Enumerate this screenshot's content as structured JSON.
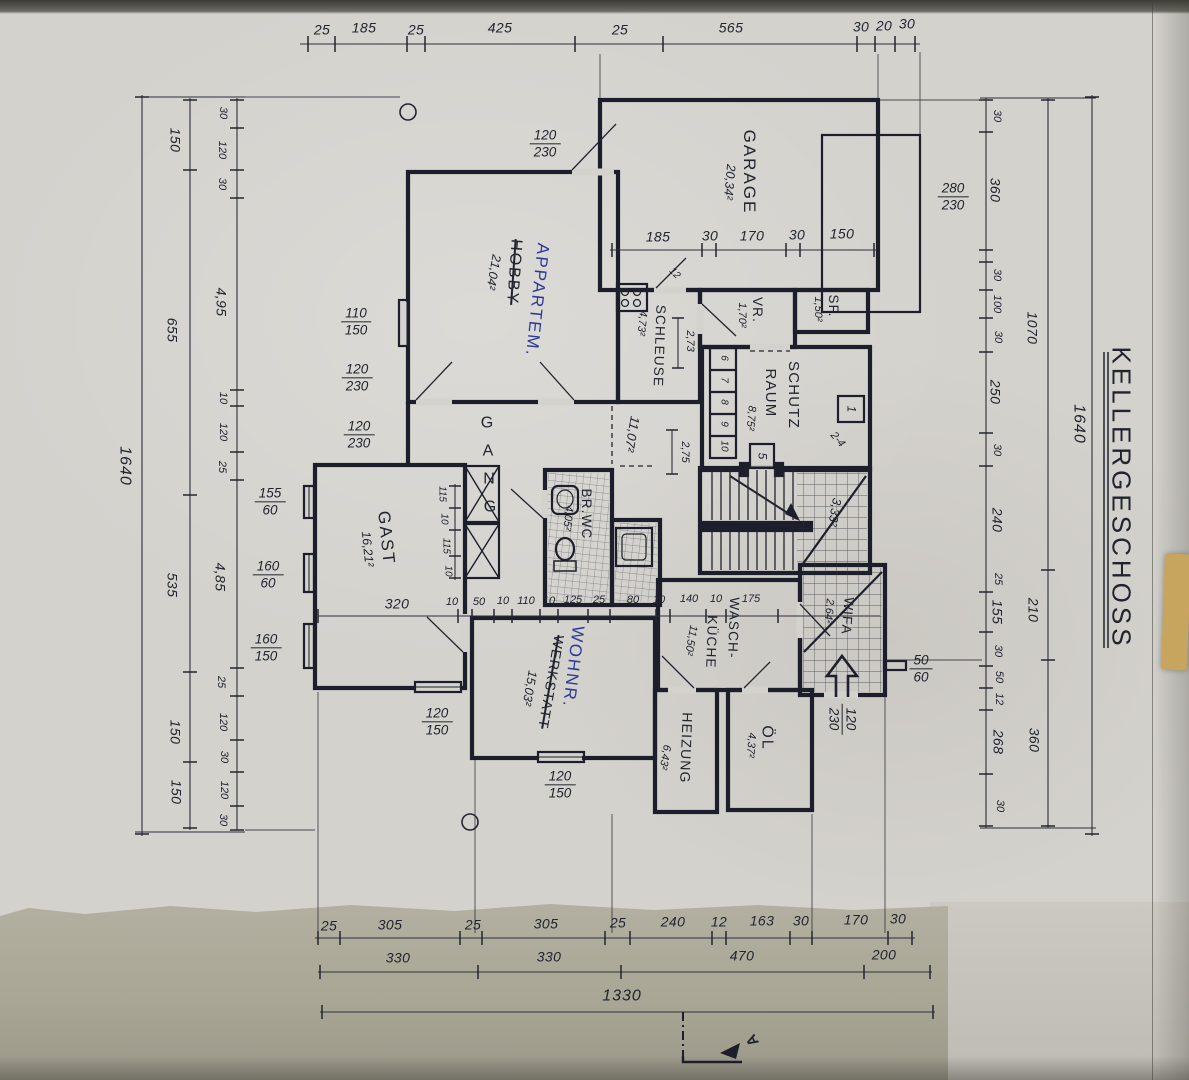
{
  "meta": {
    "plan_title": "KELLERGESCHOSS",
    "section_marker": "A",
    "total_width": "1330",
    "total_height": "1640",
    "ink_color": "#1c1f2b",
    "blue_pen_color": "#2c3a96",
    "paper_color": "#d4d2cd"
  },
  "rooms": {
    "garage": {
      "name": "GARAGE",
      "area": "20,34²"
    },
    "hobby": {
      "name": "HOBBY",
      "renamed": "APPARTEM.",
      "area": "21,04²"
    },
    "schleuse": {
      "name": "SCHLEUSE",
      "area": "4,73²"
    },
    "vr": {
      "name": "VR.",
      "area": "1,70²"
    },
    "sf": {
      "name": "SF.",
      "area": "1,50²"
    },
    "schutzraum": {
      "name_line1": "SCHUTZ",
      "name_line2": "RAUM",
      "area": "8,75²",
      "bed_numbers": [
        "6",
        "7",
        "8",
        "9",
        "10"
      ],
      "bed_right_top": "1",
      "bed_right_mid": "2-4",
      "bed_door": "5"
    },
    "gang": {
      "letters": [
        "G",
        "A",
        "N",
        "G"
      ],
      "area": "11,07²"
    },
    "gast": {
      "name": "GAST",
      "area": "16,21²"
    },
    "brwc": {
      "name": "BR.WC",
      "area": "4,05²"
    },
    "werkstatt": {
      "name": "WERKSTATT",
      "renamed": "WOHNR.",
      "area": "15,03²"
    },
    "waschkueche": {
      "name_line1": "WASCH-",
      "name_line2": "KÜCHE",
      "area": "11,50²"
    },
    "wifa": {
      "name": "WIFA",
      "area": "2,64²"
    },
    "heizung": {
      "name": "HEIZUNG",
      "area": "6,43²"
    },
    "oel": {
      "name": "ÖL",
      "area": "4,37²"
    },
    "stair_landing": {
      "area": "3,33²"
    }
  },
  "dims": {
    "top": [
      "25",
      "185",
      "25",
      "425",
      "25",
      "565",
      "30",
      "20",
      "30"
    ],
    "garage_line": [
      "185",
      "30",
      "170",
      "30",
      "150"
    ],
    "mid_line": [
      "320",
      "10",
      "50",
      "10",
      "110",
      "10",
      "125",
      "25",
      "80",
      "10",
      "140",
      "10",
      "175"
    ],
    "bottom_r1": [
      "25",
      "305",
      "25",
      "305",
      "25",
      "240",
      "12",
      "163",
      "30",
      "170",
      "30"
    ],
    "bottom_r2": [
      "330",
      "330",
      "470",
      "200"
    ],
    "bottom_total": "1330",
    "left_inner": [
      "30",
      "120",
      "30",
      "4,95",
      "10",
      "120",
      "25",
      "4,85",
      "25",
      "120",
      "30",
      "120",
      "30"
    ],
    "left_mid": [
      "150",
      "655",
      "535",
      "150",
      "150"
    ],
    "left_total": "1640",
    "right_inner": [
      "30",
      "360",
      "30",
      "100",
      "30",
      "250",
      "30",
      "240",
      "25",
      "155",
      "30",
      "50",
      "12",
      "268",
      "30"
    ],
    "right_mid": [
      "1070",
      "210",
      "360"
    ],
    "right_total": "1640",
    "gast_chain": [
      "115",
      "10",
      "115",
      "10"
    ],
    "schleuse_h": "2,73",
    "gang_h": "2,75",
    "small_12": "12"
  },
  "openings": {
    "top_door": {
      "w": "120",
      "h": "230"
    },
    "garage_door": {
      "w": "280",
      "h": "230"
    },
    "hobby_win": {
      "w": "110",
      "h": "150"
    },
    "hobby_door1": {
      "w": "120",
      "h": "230"
    },
    "hobby_door2": {
      "w": "120",
      "h": "230"
    },
    "gast_win1": {
      "w": "155",
      "h": "60"
    },
    "gast_win2": {
      "w": "160",
      "h": "60"
    },
    "gast_win3": {
      "w": "160",
      "h": "150"
    },
    "gast_s_win": {
      "w": "120",
      "h": "150"
    },
    "wohnr_s_win": {
      "w": "120",
      "h": "150"
    },
    "entry_win": {
      "w": "50",
      "h": "60"
    },
    "entry_door": {
      "w": "120",
      "h": "230"
    }
  }
}
